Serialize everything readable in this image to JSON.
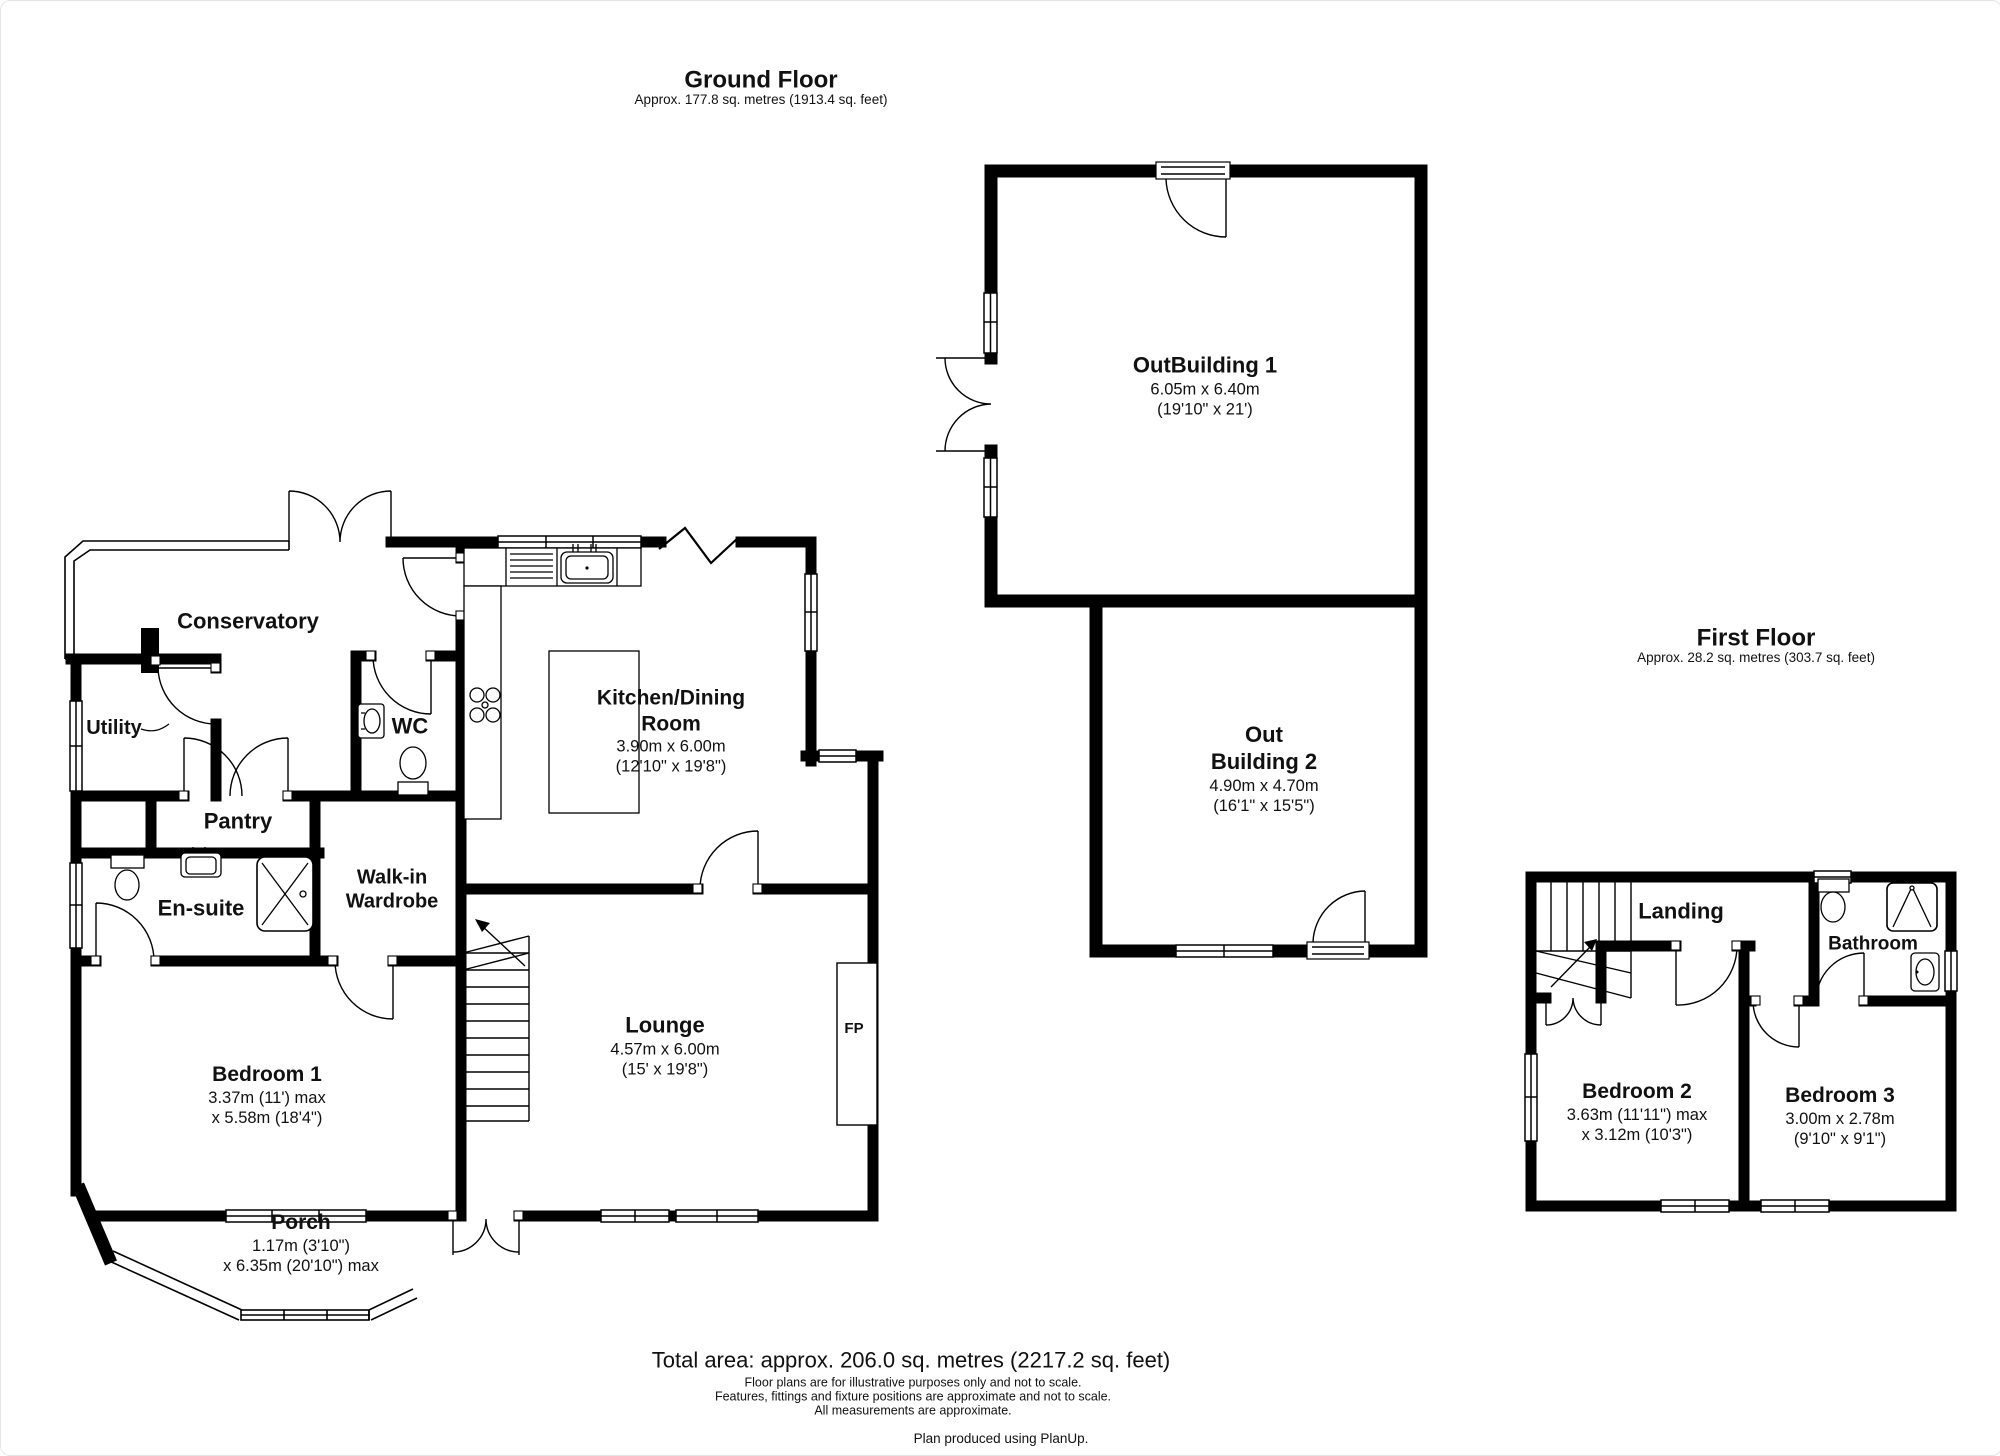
{
  "colors": {
    "ink": "#000000",
    "paper": "#ffffff"
  },
  "ground_floor": {
    "title": "Ground Floor",
    "subtitle": "Approx. 177.8 sq. metres (1913.4 sq. feet)",
    "rooms": {
      "conservatory": {
        "label": "Conservatory"
      },
      "utility": {
        "label": "Utility"
      },
      "wc": {
        "label": "WC"
      },
      "pantry": {
        "label": "Pantry"
      },
      "ensuite": {
        "label": "En-suite"
      },
      "walk_in_wardrobe": {
        "label": "Walk-in Wardrobe"
      },
      "kitchen_dining": {
        "label": "Kitchen/Dining Room",
        "dim_metric": "3.90m x 6.00m",
        "dim_imperial": "(12'10\" x 19'8\")"
      },
      "lounge": {
        "label": "Lounge",
        "dim_metric": "4.57m x 6.00m",
        "dim_imperial": "(15' x 19'8\")"
      },
      "bedroom1": {
        "label": "Bedroom 1",
        "dim_metric": "3.37m (11') max",
        "dim_imperial": "x 5.58m (18'4\")"
      },
      "porch": {
        "label": "Porch",
        "dim_metric": "1.17m (3'10\")",
        "dim_imperial": "x 6.35m (20'10\") max"
      },
      "fireplace": {
        "label": "FP"
      }
    }
  },
  "outbuildings": {
    "outbuilding1": {
      "label": "OutBuilding 1",
      "dim_metric": "6.05m x 6.40m",
      "dim_imperial": "(19'10\" x 21')"
    },
    "outbuilding2": {
      "label": "Out Building 2",
      "dim_metric": "4.90m x 4.70m",
      "dim_imperial": "(16'1\" x 15'5\")"
    }
  },
  "first_floor": {
    "title": "First Floor",
    "subtitle": "Approx. 28.2 sq. metres (303.7 sq. feet)",
    "rooms": {
      "landing": {
        "label": "Landing"
      },
      "bathroom": {
        "label": "Bathroom"
      },
      "bedroom2": {
        "label": "Bedroom 2",
        "dim_metric": "3.63m (11'11\") max",
        "dim_imperial": "x 3.12m (10'3\")"
      },
      "bedroom3": {
        "label": "Bedroom 3",
        "dim_metric": "3.00m x 2.78m",
        "dim_imperial": "(9'10\" x 9'1\")"
      }
    }
  },
  "footer": {
    "total_area": "Total area: approx. 206.0 sq. metres (2217.2 sq. feet)",
    "disclaimers": [
      "Floor plans are for illustrative purposes only and not to scale.",
      "Features, fittings and fixture positions are approximate and not to scale.",
      "All measurements are approximate."
    ],
    "credit": "Plan produced using PlanUp."
  }
}
